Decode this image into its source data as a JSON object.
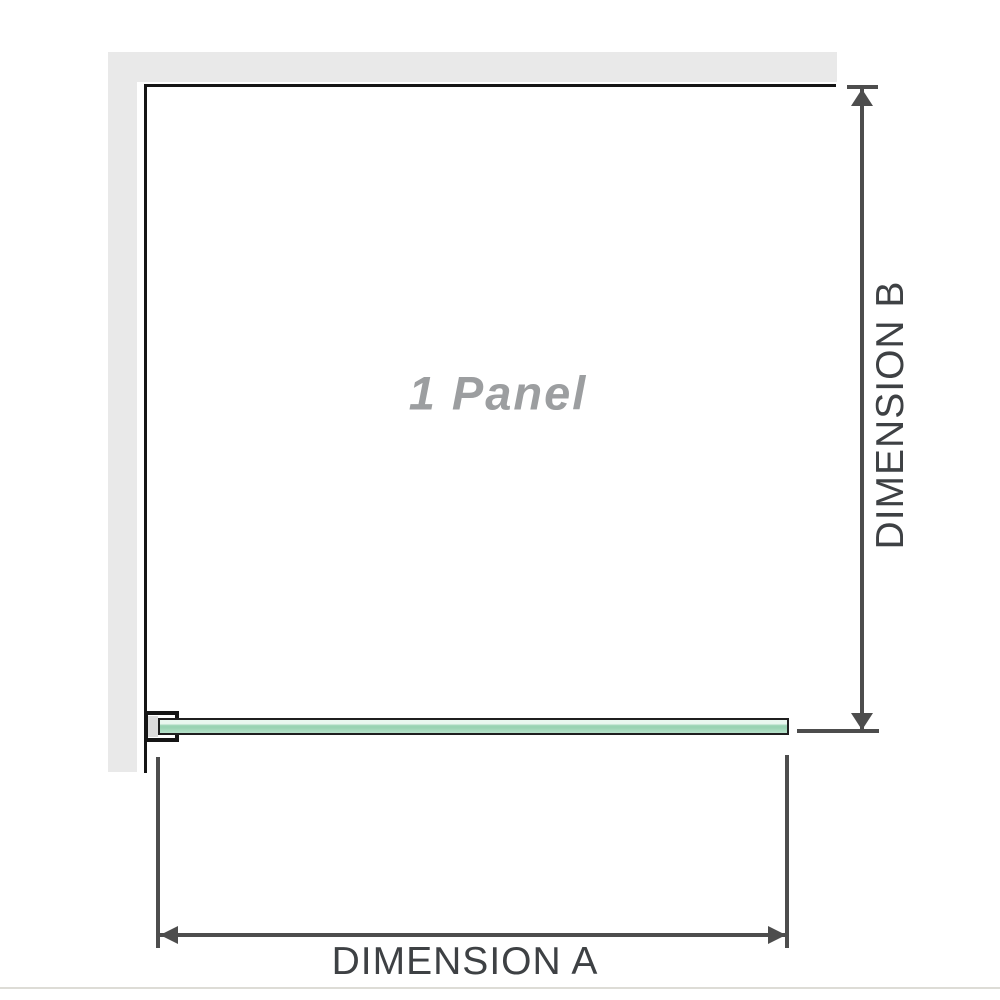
{
  "diagram": {
    "panel_label": "1 Panel",
    "dimension_a_label": "DIMENSION A",
    "dimension_b_label": "DIMENSION B"
  },
  "colors": {
    "background": "#ffffff",
    "wall": "#e9e9e9",
    "outline": "#151515",
    "dimension": "#4d4d4d",
    "label-text": "#3e4144",
    "panel-text": "#9c9ea0",
    "bracket-spacer": "#dcdcdc",
    "glass-hi": "#e9f7ef",
    "glass-mid": "#99d3b3",
    "glass-lo": "#b7e2ca",
    "glass-edge": "#1f1f1f",
    "baseline": "#dddcd6"
  }
}
